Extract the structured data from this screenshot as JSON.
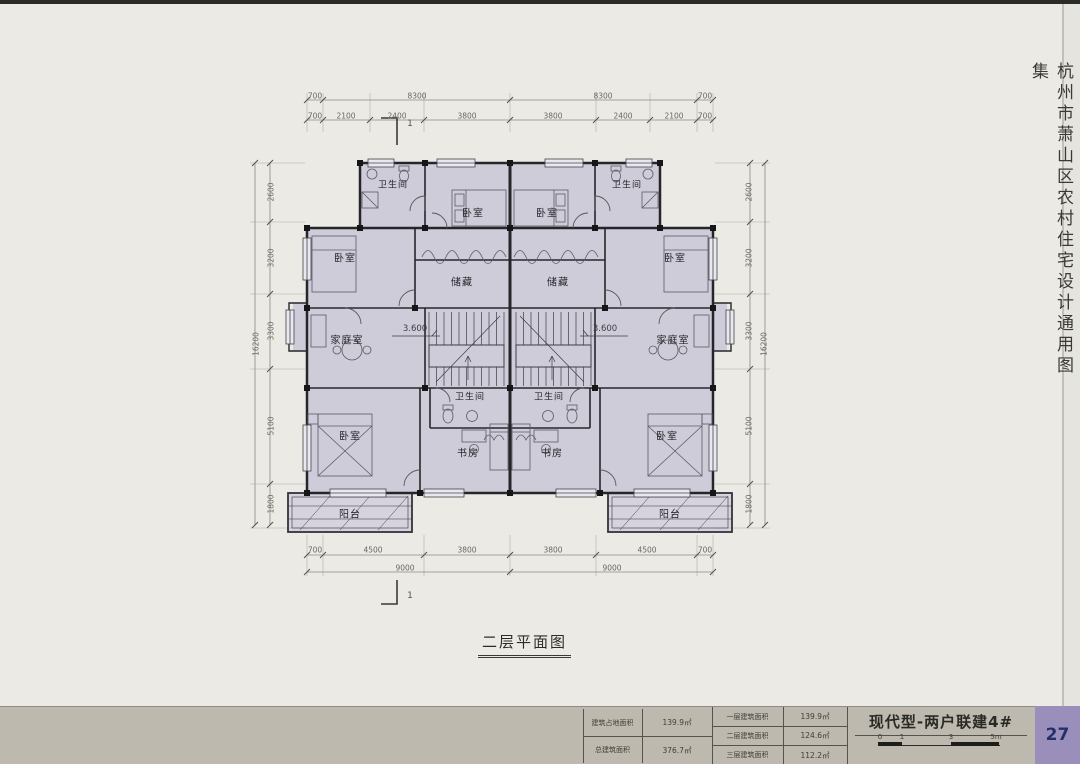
{
  "page": {
    "side_title": "杭州市萧山区农村住宅设计通用图集",
    "plan_title": "二层平面图",
    "page_number": "27"
  },
  "plan": {
    "rooms": {
      "bathroom": "卫生间",
      "bedroom": "卧室",
      "storage": "储藏",
      "family": "家庭室",
      "study": "书房",
      "balcony": "阳台"
    },
    "level_label": "3.600",
    "section_label": "1"
  },
  "dims": {
    "top1": [
      "700",
      "8300",
      "8300",
      "700"
    ],
    "top2": [
      "700",
      "2100",
      "2400",
      "3800",
      "3800",
      "2400",
      "2100",
      "700"
    ],
    "bottom1": [
      "700",
      "4500",
      "3800",
      "3800",
      "4500",
      "700"
    ],
    "bottom2": [
      "9000",
      "9000"
    ],
    "left": [
      "2600",
      "3200",
      "3300",
      "5100",
      "1800"
    ],
    "left_total": "16200",
    "right": [
      "2600",
      "3200",
      "3300",
      "5100",
      "1800"
    ],
    "right_total": "16200"
  },
  "title_block": {
    "series_title": "现代型-两户联建4#",
    "areas_left": [
      {
        "label": "建筑占地面积",
        "value": "139.9㎡"
      },
      {
        "label": "总建筑面积",
        "value": "376.7㎡"
      }
    ],
    "areas_right": [
      {
        "label": "一层建筑面积",
        "value": "139.9㎡"
      },
      {
        "label": "二层建筑面积",
        "value": "124.6㎡"
      },
      {
        "label": "三层建筑面积",
        "value": "112.2㎡"
      }
    ],
    "scale_labels": [
      "0",
      "1",
      "3",
      "5m"
    ]
  },
  "colors": {
    "page_bg": "#ECEAE5",
    "bottom_strip": "#BDB9AE",
    "page_number_bg": "#9A8EBB",
    "page_number_text": "#24306A",
    "floor_fill": "#CFCCDA",
    "wall": "#26262A"
  }
}
